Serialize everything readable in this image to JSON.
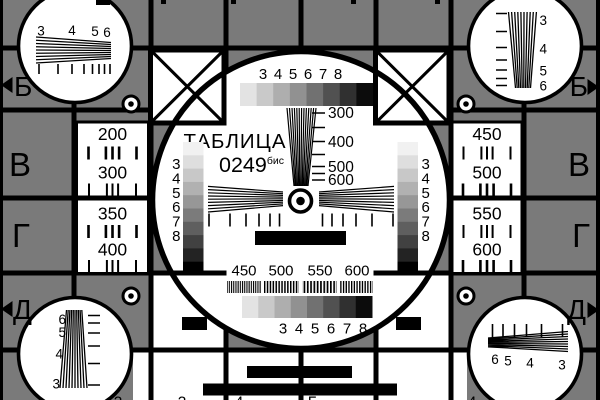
{
  "card": {
    "title": "ТАБЛИЦА",
    "code": "0249",
    "code_sup": "бис",
    "top_scale": [
      "3",
      "4",
      "5",
      "6",
      "7",
      "8"
    ],
    "bottom_scale": [
      "3",
      "4",
      "5",
      "6",
      "7",
      "8"
    ],
    "left_scale": [
      "3",
      "4",
      "5",
      "6",
      "7",
      "8"
    ],
    "right_scale": [
      "3",
      "4",
      "5",
      "6",
      "7",
      "8"
    ],
    "freq_marks": [
      "300",
      "400",
      "500",
      "600"
    ],
    "burst_marks": [
      "450",
      "500",
      "550",
      "600"
    ],
    "left_panel": [
      "200",
      "300",
      "350",
      "400"
    ],
    "right_panel": [
      "450",
      "500",
      "550",
      "600"
    ],
    "margin_left": [
      "Б",
      "В",
      "Г",
      "Д"
    ],
    "margin_right": [
      "Б",
      "В",
      "Г",
      "Д"
    ],
    "corner_tl": [
      "3",
      "4",
      "5",
      "6"
    ],
    "corner_tr": [
      "3",
      "4",
      "5",
      "6"
    ],
    "corner_bl": [
      "6",
      "5",
      "4",
      "3"
    ],
    "corner_br": [
      "6",
      "5",
      "4",
      "3"
    ],
    "bottom_edge_glyphs": [
      "3",
      "3",
      "4",
      "Г",
      "4",
      "4"
    ],
    "colors": {
      "background": "#7a7a7a",
      "ink": "#000000",
      "paper": "#ffffff"
    },
    "palette8": [
      "#e3e3e3",
      "#c9c9c9",
      "#aeaeae",
      "#919191",
      "#717171",
      "#515151",
      "#303030",
      "#0c0c0c"
    ],
    "palette10": [
      "#f1f1f1",
      "#dedede",
      "#c8c8c8",
      "#b1b1b1",
      "#979797",
      "#7b7b7b",
      "#5f5f5f",
      "#414141",
      "#232323",
      "#000000"
    ]
  }
}
